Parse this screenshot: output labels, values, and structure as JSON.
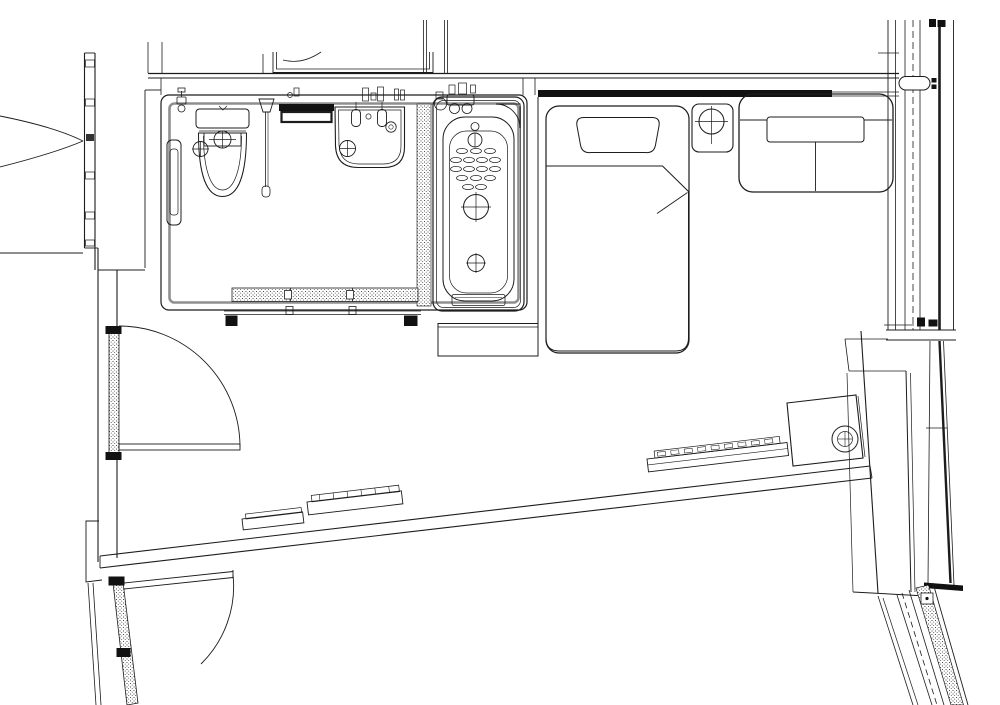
{
  "drawing": {
    "kind": "architectural-floor-plan",
    "subject": "hotel guest room plan with unit bathroom, single bed, sofa and window wall",
    "text_labels": [],
    "colors": {
      "background": "#ffffff",
      "line": "#1c1c1c",
      "wall_gray": "#8f8f8f",
      "solid_fill": "#111111",
      "light_line": "#9a9a9a"
    },
    "rooms": [
      {
        "name": "bathroom",
        "fixtures": [
          "toilet",
          "toilet-control-panel",
          "toilet-paper-holder",
          "hand-shower",
          "towel-rack",
          "washbasin",
          "basin-faucets",
          "bathtub",
          "tub-faucet-deck",
          "corner-shelf",
          "floor-drains",
          "sliding-door"
        ]
      },
      {
        "name": "bedroom",
        "fixtures": [
          "single-bed",
          "pillow",
          "duvet-with-folded-corner",
          "headboard-panel",
          "nightstand",
          "table-lamp",
          "sofa",
          "luggage-bench",
          "console-unit",
          "perimeter-units"
        ]
      },
      {
        "name": "entry",
        "fixtures": [
          "room-door",
          "secondary-door",
          "door-frames"
        ]
      },
      {
        "name": "corridor",
        "fixtures": [
          "opposite-door-swing-arcs"
        ]
      }
    ],
    "openings": [
      "double-swing-arcs-left",
      "hinged-room-door",
      "hinged-secondary-door",
      "three-panel-bathroom-sliding-door",
      "curtain-wall-window-right",
      "slanted-window-band-lower-right",
      "closet-niche-top"
    ],
    "counts": {
      "bathroom_sliding_door_panels": 3,
      "beds": 1,
      "sofa_seats": 2,
      "perimeter_units": 3
    }
  }
}
